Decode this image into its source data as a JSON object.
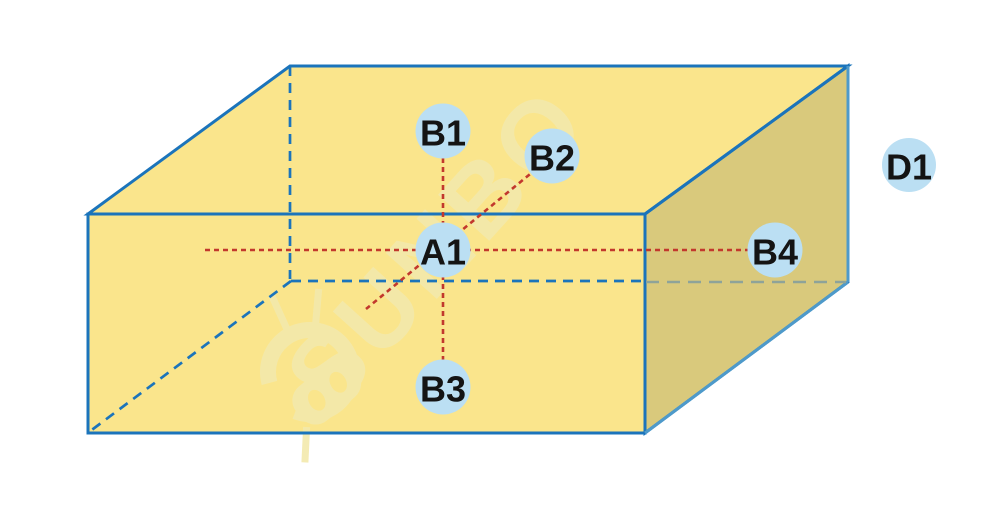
{
  "diagram": {
    "description": "3D cuboid diagram with labeled measurement points and dotted axes",
    "canvas": {
      "width": 1000,
      "height": 517
    },
    "colors": {
      "face_light": "#FAE58C",
      "face_dark": "#D9C97C",
      "edge_blue": "#1B74BB",
      "edge_blue_light": "#4E9ACA",
      "hidden_gray": "#8EA399",
      "axis_red": "#C2382D",
      "node_fill": "#BBDFF3",
      "node_text": "#141414",
      "watermark": "#F3E9AC"
    },
    "box": {
      "faces": [
        {
          "name": "top-face",
          "fill": "face_light",
          "points": [
            [
              88,
              214
            ],
            [
              290,
              66
            ],
            [
              848,
              66
            ],
            [
              645,
              214
            ]
          ]
        },
        {
          "name": "front-face",
          "fill": "face_light",
          "points": [
            [
              88,
              214
            ],
            [
              645,
              214
            ],
            [
              645,
              433
            ],
            [
              88,
              433
            ]
          ]
        },
        {
          "name": "right-face",
          "fill": "face_dark",
          "points": [
            [
              645,
              214
            ],
            [
              848,
              66
            ],
            [
              848,
              282
            ],
            [
              645,
              433
            ]
          ]
        }
      ],
      "outlines": [
        {
          "name": "top-face-outline",
          "points": [
            [
              88,
              214
            ],
            [
              290,
              66
            ],
            [
              848,
              66
            ],
            [
              645,
              214
            ]
          ]
        },
        {
          "name": "front-face-outline",
          "points": [
            [
              88,
              214
            ],
            [
              645,
              214
            ],
            [
              645,
              433
            ],
            [
              88,
              433
            ]
          ]
        },
        {
          "name": "right-face-outline",
          "points": [
            [
              645,
              214
            ],
            [
              848,
              66
            ],
            [
              848,
              282
            ],
            [
              645,
              433
            ]
          ]
        }
      ],
      "light_edges": [
        {
          "name": "back-right-vertical-edge",
          "from": [
            848,
            66
          ],
          "to": [
            848,
            282
          ]
        },
        {
          "name": "bottom-right-slant-edge",
          "from": [
            848,
            282
          ],
          "to": [
            645,
            433
          ]
        }
      ],
      "hidden_edges": [
        {
          "name": "hidden-back-left-vertical",
          "from": [
            290,
            66
          ],
          "to": [
            290,
            279
          ],
          "color": "edge_blue",
          "dash": "10 7",
          "width": 2.7
        },
        {
          "name": "hidden-bottom-back-left",
          "from": [
            291,
            281
          ],
          "to": [
            644,
            281
          ],
          "color": "edge_blue",
          "dash": "10 7",
          "width": 2.7
        },
        {
          "name": "hidden-bottom-back-right",
          "from": [
            646,
            282
          ],
          "to": [
            846,
            282
          ],
          "color": "hidden_gray",
          "dash": "13 8",
          "width": 2.5
        },
        {
          "name": "hidden-bottom-left-slant",
          "from": [
            291,
            281
          ],
          "to": [
            89,
            432
          ],
          "color": "edge_blue",
          "dash": "10 7",
          "width": 2.7
        }
      ]
    },
    "axes": [
      {
        "name": "axis-horizontal",
        "from": [
          205,
          250
        ],
        "to": [
          775,
          250
        ],
        "dash": "5 4",
        "width": 2.6
      },
      {
        "name": "axis-vertical",
        "from": [
          443,
          131
        ],
        "to": [
          443,
          387
        ],
        "dash": "5 4",
        "width": 2.6
      },
      {
        "name": "axis-diagonal",
        "from": [
          366,
          309
        ],
        "to": [
          552,
          156
        ],
        "dash": "5 4",
        "width": 2.6
      }
    ],
    "nodes": [
      {
        "id": "A1",
        "label": "A1",
        "x": 443,
        "y": 250,
        "r": 27.5
      },
      {
        "id": "B1",
        "label": "B1",
        "x": 443,
        "y": 131,
        "r": 27.5
      },
      {
        "id": "B2",
        "label": "B2",
        "x": 552,
        "y": 156,
        "r": 27.5
      },
      {
        "id": "B3",
        "label": "B3",
        "x": 443,
        "y": 387,
        "r": 27.5
      },
      {
        "id": "B4",
        "label": "B4",
        "x": 775,
        "y": 250,
        "r": 27.5
      },
      {
        "id": "D1",
        "label": "D1",
        "x": 909,
        "y": 165,
        "r": 27.0
      }
    ],
    "node_font_size": 36
  },
  "watermark": {
    "text": "SUNBO",
    "rotation_deg": -48,
    "center": [
      437,
      248
    ]
  }
}
